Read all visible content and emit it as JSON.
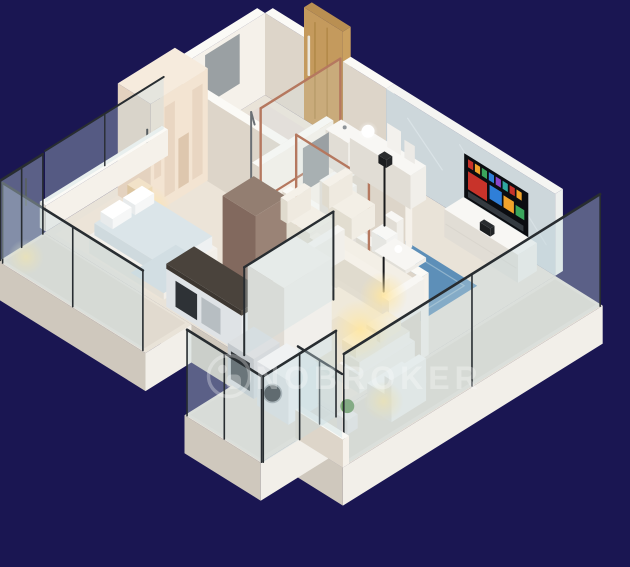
{
  "scene": {
    "type": "3d-isometric-floor-plan-render",
    "background_color": "#1a1652",
    "rooms": [
      {
        "name": "master-bedroom",
        "furniture": [
          "arched-wardrobe",
          "double-bed",
          "nightstand",
          "pendant-light"
        ]
      },
      {
        "name": "master-bathroom",
        "furniture": [
          "shower",
          "vanity-basin",
          "mirror",
          "copper-glass-partition"
        ]
      },
      {
        "name": "entrance-foyer",
        "furniture": [
          "wooden-entrance-door",
          "sideboard",
          "ball-lamp",
          "photo-frames"
        ]
      },
      {
        "name": "living-room",
        "furniture": [
          "curved-smart-tv",
          "tv-unit",
          "three-seat-sofa",
          "armchair",
          "armchair",
          "coffee-table",
          "blue-rug",
          "floor-lamp"
        ]
      },
      {
        "name": "common-bathroom",
        "furniture": [
          "vanity-basin",
          "toilet",
          "mirror",
          "copper-glass-partition",
          "plant"
        ]
      },
      {
        "name": "kitchen",
        "furniture": [
          "dark-countertop",
          "oven",
          "refrigerator"
        ]
      },
      {
        "name": "second-bedroom",
        "furniture": [
          "double-bed",
          "wardrobe",
          "pendant-light"
        ]
      },
      {
        "name": "utility-balcony",
        "furniture": [
          "washing-machine",
          "dishwasher",
          "glass-railing"
        ]
      },
      {
        "name": "left-balcony",
        "furniture": [
          "glass-railing",
          "pendant-light"
        ]
      },
      {
        "name": "right-balcony",
        "furniture": [
          "glass-railing",
          "lounge-seat",
          "plant"
        ]
      }
    ]
  },
  "watermark": {
    "text": "NOBROKER",
    "logo": "nobroker-circle-logo",
    "color": "#ffffff",
    "opacity": 0.3
  },
  "palette": {
    "background": "#1a1652",
    "wall_top": "#fbfaf6",
    "wall_light": "#f5f1ea",
    "wall_shade": "#ddd5c9",
    "floor": "#e9e3d8",
    "slab_side_light": "#f2efe9",
    "slab_side_shade": "#cfc8bd",
    "accent_wall": "#cdd7db",
    "copper_frame": "#b5785f",
    "dark_frame": "#282d31",
    "glass": "#c6dbdf",
    "wood_door": "#c49a5d",
    "wardrobe_cream": "#f3e4d2",
    "bed_blue": "#dbe5e9",
    "bed_cream": "#efe9da",
    "rug_blue": "#5d8fb8",
    "counter_dark": "#4a433c",
    "fridge_brown": "#8d7568",
    "glow_warm": "#ffe6a0"
  },
  "tv": {
    "content": "smart-tv-app-grid",
    "tile_colors": [
      "#c8332a",
      "#f1a32b",
      "#3aa65c",
      "#2f7fd8",
      "#8a46c9",
      "#2fa8a0"
    ]
  }
}
